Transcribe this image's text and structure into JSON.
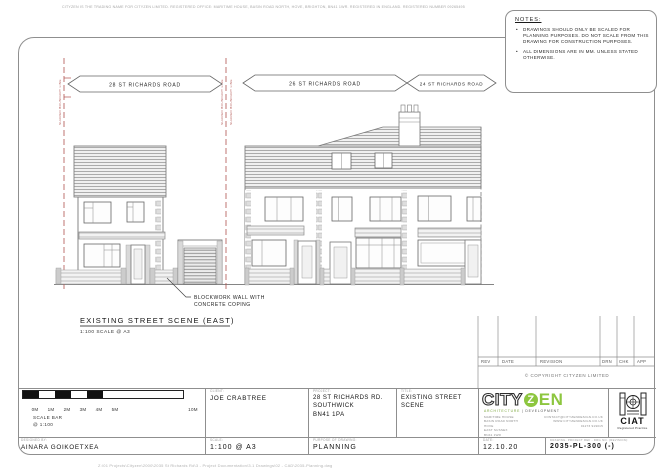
{
  "page": {
    "top_disclaimer": "CITYZEN IS THE TRADING NAME FOR CITYZEN LIMITED. REGISTERED OFFICE: MARITIME HOUSE, BASIN ROAD NORTH, HOVE, BRIGHTON, BN41 1WR. REGISTERED IN ENGLAND. REGISTERED NUMBER 09265495",
    "file_path": "Z:\\01 Projects\\Cityzen\\2000\\2035 St Richards Rd\\3 - Project Documentation\\3.1 Drawings\\02 - CAD\\2035-Planning.dwg"
  },
  "notes": {
    "heading": "NOTES:",
    "items": [
      "DRAWINGS SHOULD ONLY BE SCALED FOR PLANNING PURPOSES. DO NOT SCALE FROM THIS DRAWING FOR CONSTRUCTION PURPOSES.",
      "ALL DIMENSIONS ARE IN MM. UNLESS STATED OTHERWISE."
    ]
  },
  "drawing": {
    "banners": [
      {
        "label": "28 ST RICHARDS ROAD"
      },
      {
        "label": "26 ST RICHARDS ROAD"
      },
      {
        "label": "24 ST RICHARDS ROAD"
      }
    ],
    "boundary_label": "SHARED BOUNDARY LINE",
    "boundary_color": "#b0524e",
    "annotation_line1": "BLOCKWORK WALL WITH",
    "annotation_line2": "CONCRETE COPING",
    "title": "EXISTING STREET SCENE (EAST)",
    "subtitle": "1:100 SCALE @ A3"
  },
  "revision_table": {
    "headers": [
      "REV",
      "DATE",
      "REVISION",
      "DRN",
      "CHK",
      "APP"
    ]
  },
  "copyright_note": "© COPYRIGHT CITYZEN LIMITED",
  "scale_bar": {
    "labels": [
      "0M",
      "1M",
      "2M",
      "3M",
      "4M",
      "5M",
      "10M"
    ],
    "caption_line1": "SCALE BAR",
    "caption_line2": "@ 1:100"
  },
  "title_block": {
    "designer_label": "DESIGNED BY:",
    "designer": "AINARA GOIKOETXEA",
    "client_label": "CLIENT:",
    "client": "JOE CRABTREE",
    "project_label": "PROJECT:",
    "project_lines": [
      "28 ST RICHARDS RD.",
      "SOUTHWICK",
      "BN41 1PA"
    ],
    "title_label": "TITLE:",
    "title_lines": [
      "EXISTING STREET",
      "SCENE"
    ],
    "scale_label": "SCALE:",
    "scale": "1:100 @ A3",
    "purpose_label": "PURPOSE OF DRAWING:",
    "purpose": "PLANNING",
    "date_label": "DATE:",
    "date": "12.10.20",
    "drawing_no_label": "DRAWING- PROJECT REF - DRG NO. (REVISION):",
    "drawing_no": "2035-PL-300 (-)"
  },
  "branding": {
    "logo_city": "CITY",
    "logo_z": "Z",
    "logo_en": "EN",
    "tagline_left": "ARCHITECTURE",
    "tagline_right": "| DEVELOPMENT",
    "green": "#8dc63f",
    "address_lines": [
      "MARITIME HOUSE",
      "BASIN ROAD NORTH",
      "HOVE",
      "EAST SUSSEX",
      "BN41 1WR"
    ],
    "contact_lines": [
      "CONTACT@CITYZENDESIGN.CO.UK",
      "WWW.CITYZENDESIGN.CO.UK",
      "01273 919015"
    ],
    "ciat_name": "CIAT",
    "ciat_sub": "Registered Practice"
  }
}
